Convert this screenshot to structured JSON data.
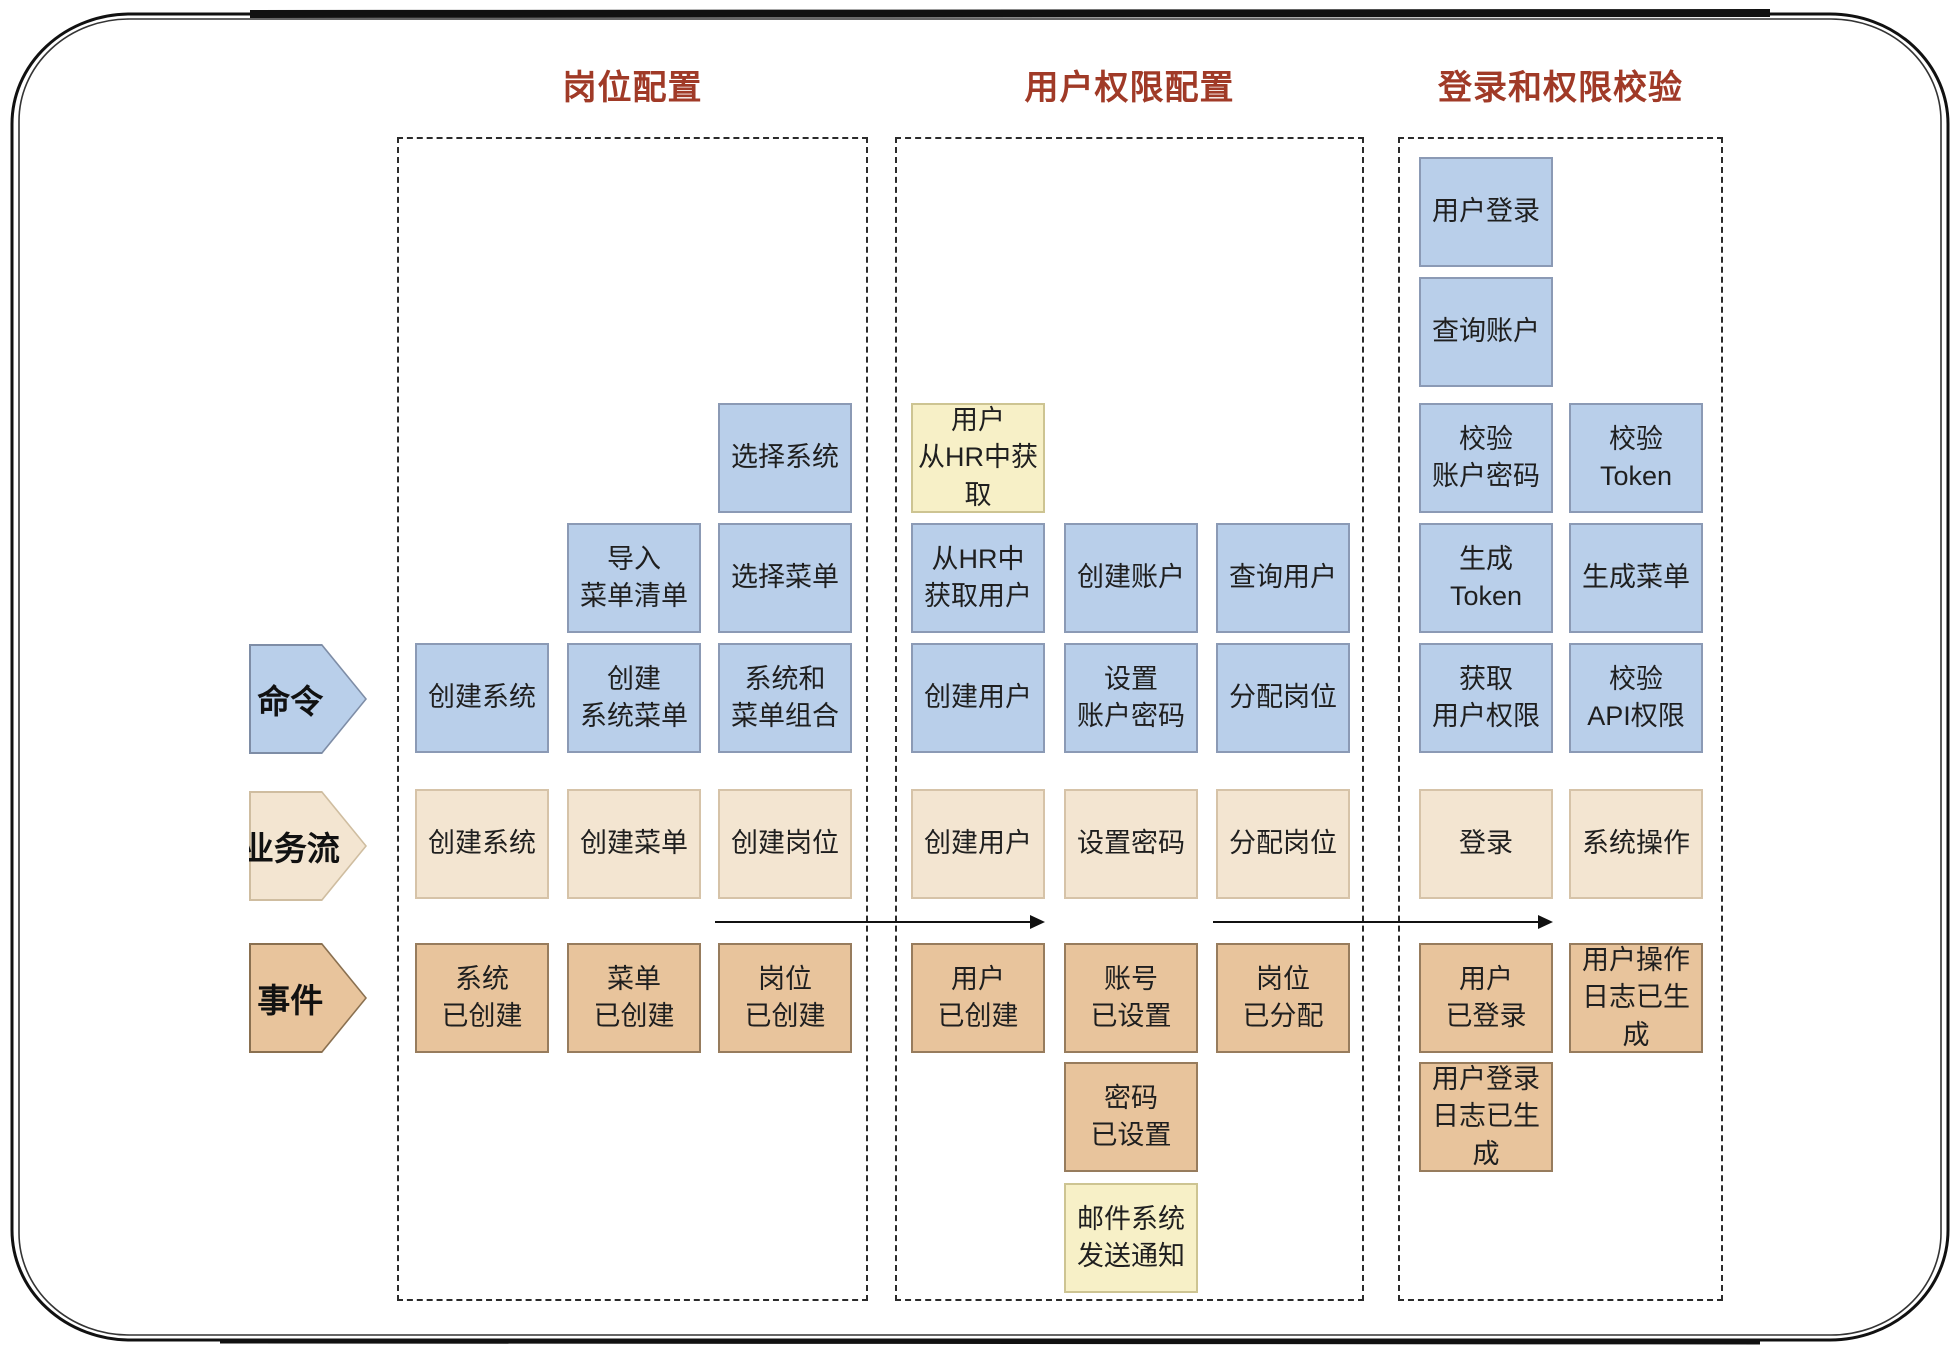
{
  "colors": {
    "command_fill": "#b9cfea",
    "command_border": "#8b9ab5",
    "flow_fill": "#f3e5d1",
    "flow_border": "#d6c3a8",
    "event_fill": "#e8c49c",
    "event_border": "#977c5d",
    "external_fill": "#f7f0c7",
    "external_border": "#cdc492",
    "header_text": "#a03a27",
    "note_text": "#1f1f1f",
    "frame": "#111111"
  },
  "row_labels": [
    {
      "id": "command",
      "label": "命令",
      "row": "command",
      "shape": "command-shape"
    },
    {
      "id": "flow",
      "label": "业务流",
      "row": "flow",
      "shape": "flow-shape"
    },
    {
      "id": "event",
      "label": "事件",
      "row": "event",
      "shape": "event-shape"
    }
  ],
  "sections": [
    {
      "id": "position-config",
      "header": "岗位配置",
      "boxes": [
        {
          "col": 2,
          "row": "r3",
          "type": "command",
          "label": "选择系统"
        },
        {
          "col": 1,
          "row": "r4",
          "type": "command",
          "label": "导入\n菜单清单"
        },
        {
          "col": 2,
          "row": "r4",
          "type": "command",
          "label": "选择菜单"
        },
        {
          "col": 0,
          "row": "command",
          "type": "command",
          "label": "创建系统"
        },
        {
          "col": 1,
          "row": "command",
          "type": "command",
          "label": "创建\n系统菜单"
        },
        {
          "col": 2,
          "row": "command",
          "type": "command",
          "label": "系统和\n菜单组合"
        },
        {
          "col": 0,
          "row": "flow",
          "type": "flow",
          "label": "创建系统"
        },
        {
          "col": 1,
          "row": "flow",
          "type": "flow",
          "label": "创建菜单"
        },
        {
          "col": 2,
          "row": "flow",
          "type": "flow",
          "label": "创建岗位"
        },
        {
          "col": 0,
          "row": "event",
          "type": "event",
          "label": "系统\n已创建"
        },
        {
          "col": 1,
          "row": "event",
          "type": "event",
          "label": "菜单\n已创建"
        },
        {
          "col": 2,
          "row": "event",
          "type": "event",
          "label": "岗位\n已创建"
        }
      ]
    },
    {
      "id": "user-permission-config",
      "header": "用户权限配置",
      "boxes": [
        {
          "col": 0,
          "row": "r3",
          "type": "external",
          "label": "用户\n从HR中获取"
        },
        {
          "col": 0,
          "row": "r4",
          "type": "command",
          "label": "从HR中\n获取用户"
        },
        {
          "col": 1,
          "row": "r4",
          "type": "command",
          "label": "创建账户"
        },
        {
          "col": 2,
          "row": "r4",
          "type": "command",
          "label": "查询用户"
        },
        {
          "col": 0,
          "row": "command",
          "type": "command",
          "label": "创建用户"
        },
        {
          "col": 1,
          "row": "command",
          "type": "command",
          "label": "设置\n账户密码"
        },
        {
          "col": 2,
          "row": "command",
          "type": "command",
          "label": "分配岗位"
        },
        {
          "col": 0,
          "row": "flow",
          "type": "flow",
          "label": "创建用户"
        },
        {
          "col": 1,
          "row": "flow",
          "type": "flow",
          "label": "设置密码"
        },
        {
          "col": 2,
          "row": "flow",
          "type": "flow",
          "label": "分配岗位"
        },
        {
          "col": 0,
          "row": "event",
          "type": "event",
          "label": "用户\n已创建"
        },
        {
          "col": 1,
          "row": "event",
          "type": "event",
          "label": "账号\n已设置"
        },
        {
          "col": 2,
          "row": "event",
          "type": "event",
          "label": "岗位\n已分配"
        },
        {
          "col": 1,
          "row": "event2",
          "type": "event",
          "label": "密码\n已设置"
        },
        {
          "col": 1,
          "row": "external2",
          "type": "external",
          "label": "邮件系统\n发送通知"
        }
      ]
    },
    {
      "id": "login-and-permission-verification",
      "header": "登录和权限校验",
      "boxes": [
        {
          "col": 0,
          "row": "r1",
          "type": "command",
          "label": "用户登录"
        },
        {
          "col": 0,
          "row": "r2",
          "type": "command",
          "label": "查询账户"
        },
        {
          "col": 0,
          "row": "r3",
          "type": "command",
          "label": "校验\n账户密码"
        },
        {
          "col": 1,
          "row": "r3",
          "type": "command",
          "label": "校验\nToken"
        },
        {
          "col": 0,
          "row": "r4",
          "type": "command",
          "label": "生成\nToken"
        },
        {
          "col": 1,
          "row": "r4",
          "type": "command",
          "label": "生成菜单"
        },
        {
          "col": 0,
          "row": "command",
          "type": "command",
          "label": "获取\n用户权限"
        },
        {
          "col": 1,
          "row": "command",
          "type": "command",
          "label": "校验\nAPI权限"
        },
        {
          "col": 0,
          "row": "flow",
          "type": "flow",
          "label": "登录"
        },
        {
          "col": 1,
          "row": "flow",
          "type": "flow",
          "label": "系统操作"
        },
        {
          "col": 0,
          "row": "event",
          "type": "event",
          "label": "用户\n已登录"
        },
        {
          "col": 1,
          "row": "event",
          "type": "event",
          "label": "用户操作\n日志已生成"
        },
        {
          "col": 0,
          "row": "event2",
          "type": "event",
          "label": "用户登录\n日志已生成"
        }
      ]
    }
  ],
  "flow_arrows": [
    {
      "from": {
        "section": 0,
        "col": 2
      },
      "to": {
        "section": 1,
        "col": 0
      }
    },
    {
      "from": {
        "section": 1,
        "col": 2
      },
      "to": {
        "section": 2,
        "col": 0
      }
    }
  ]
}
